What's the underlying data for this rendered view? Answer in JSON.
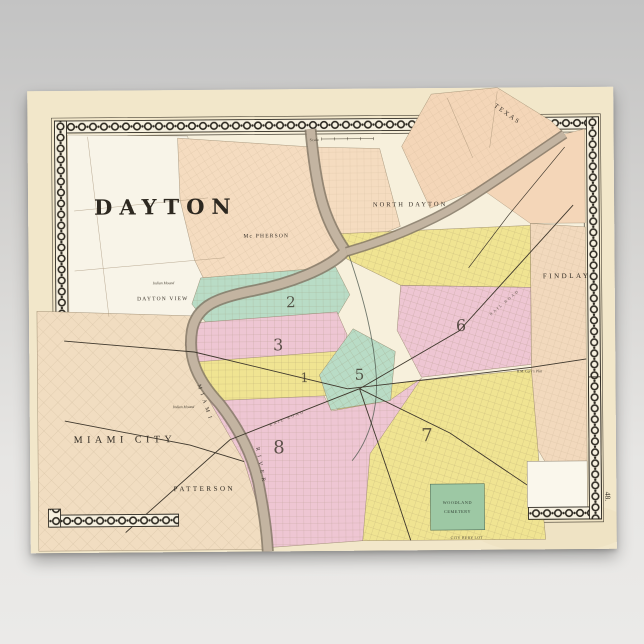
{
  "scene": {
    "background_top": "#c3c3c3",
    "background_bottom": "#ebeae8"
  },
  "poster": {
    "paper_color": "#f2e7ca",
    "page_number": "48."
  },
  "map": {
    "title": "DAYTON",
    "scale_label": "Scale",
    "districts": {
      "ward1": "1",
      "ward2": "2",
      "ward3": "3",
      "ward5": "5",
      "ward6": "6",
      "ward7": "7",
      "ward8": "8"
    },
    "places": {
      "north_dayton": "NORTH DAYTON",
      "mcpherson": "Mc PHERSON",
      "texas": "TEXAS",
      "findlay": "FINDLAY",
      "dayton_view": "DAYTON VIEW",
      "miami_city": "MIAMI CITY",
      "patterson": "PATTERSON",
      "indian_mound_1": "Indian Mound",
      "indian_mound_2": "Indian Mound",
      "carrs_plat": "R.M. Carr's Plat",
      "city_bury_lot": "CITY BURY LOT"
    },
    "cemetery": {
      "line1": "WOODLAND",
      "line2": "CEMETERY"
    },
    "river": {
      "word1": "MIAMI",
      "word2": "RIVER"
    },
    "railroads": {
      "label1": "RAIL ROAD",
      "label2": "RAIL ROAD"
    },
    "colors": {
      "paper": "#f2e7ca",
      "map_base": "#f7f0dc",
      "white_plat": "#f8f4e8",
      "peach": "#f5dcc0",
      "yellow": "#f0e492",
      "pink": "#eec6d3",
      "teal": "#b9dcc6",
      "cemetery_green": "#9dc8a4",
      "river": "#c3b4a1",
      "ink": "#2e2a22"
    }
  }
}
